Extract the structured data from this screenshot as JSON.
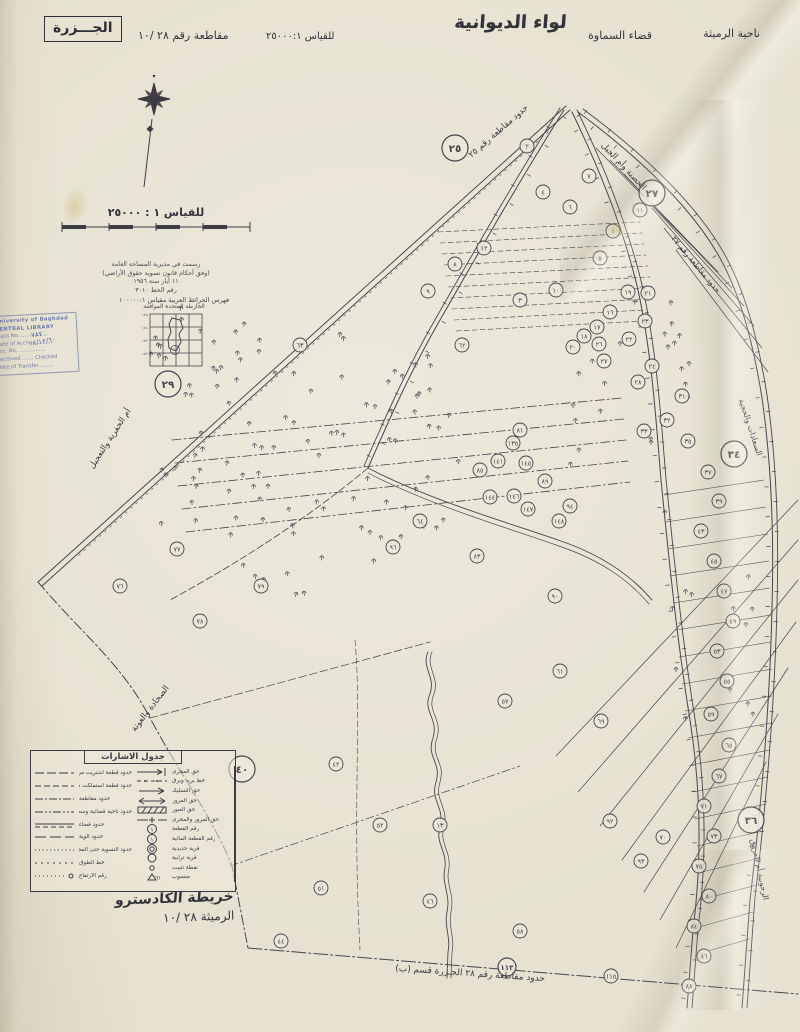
{
  "header": {
    "nahiya": "ناحية الرميثة",
    "qadha": "قضاء السماوة",
    "liwa": "لواء الديوانية",
    "scale_note": "للقياس ٢٥٠٠٠:١",
    "district_no": "مقاطعة رقم ٢٨ /١٠",
    "name_boxed": "الجـــزرة"
  },
  "scale_block": {
    "scale_text": "للقياس ١ : ٢٥٠٠٠",
    "notes": [
      "رسمت في مديرية المساحة العامة",
      "(وفق أحكام قانون تسوية حقوق الأراضي)",
      "١١ أيار سنة ١٩٥٦",
      "رقم الخط ٣٠١٠"
    ]
  },
  "index_map": {
    "title": "فهرس الخرائط العربية مقياس ١٠٠٠٠٠:١",
    "subtitle": "الخارطة المتحدة الموافقة"
  },
  "stamp": {
    "org": "University of Baghdad",
    "library": "CENTRAL LIBRARY",
    "fields": [
      "Class No. ................",
      "Date of Accng. ..........",
      "Acc. No. ................",
      "Received ....... Checked",
      "Date of Transfer ........"
    ],
    "handwritten1": "٧٨٧",
    "handwritten2": "٨/١٢/٦٠"
  },
  "legend": {
    "title": "جدول الاشارات",
    "right_items": [
      {
        "label": "حق المجرى",
        "sym": "flow"
      },
      {
        "label": "خط بريد وبرق",
        "sym": "telegraph"
      },
      {
        "label": "حق التسليك",
        "sym": "arrow"
      },
      {
        "label": "حق المرور",
        "sym": "dblarrow"
      },
      {
        "label": "حق العبور",
        "sym": "band"
      },
      {
        "label": "حق المرور والمجرى",
        "sym": "dashplus"
      },
      {
        "label": "رقم القطعة",
        "sym": "circle1"
      },
      {
        "label": "رقم القطعة المائية",
        "sym": "circle1"
      },
      {
        "label": "قرية حديدية",
        "sym": "dblcircle"
      },
      {
        "label": "قرية ترابية",
        "sym": "circle"
      },
      {
        "label": "نقطة تثبيت",
        "sym": "smallcircle"
      },
      {
        "label": "منسوب",
        "sym": "bench"
      }
    ],
    "left_items": [
      {
        "label": "حدود قطعة اشتريت من قبل مديرية الري",
        "style": "longdash"
      },
      {
        "label": "حدود قطعة استملكت من قبل الحكومة",
        "style": "dash2"
      },
      {
        "label": "حدود مقاطعة",
        "style": "dashdot"
      },
      {
        "label": "حدود ناحية قضائية وسط نهر",
        "style": "dashdotdot"
      },
      {
        "label": "حدود قضاء",
        "style": "soliddash"
      },
      {
        "label": "حدود ألوية",
        "style": "longdash2"
      },
      {
        "label": "حدود التسوية حتى المجرى",
        "style": "dotted"
      },
      {
        "label": "خط الطوق",
        "style": "dotsquares"
      },
      {
        "label": "رقم الارتفاع",
        "style": "dotso"
      }
    ]
  },
  "footer": {
    "map_type": "خريطة الكادسترو",
    "sheet": "الرميثة ٢٨ /١٠"
  },
  "map": {
    "ink_color": "#45454e",
    "paper_color": "#e6e1d0",
    "boundary_labels": [
      {
        "text": "حدود مقاطعة رقم ٢٥",
        "x": 500,
        "y": 133,
        "rot": -41,
        "size": 8.5
      },
      {
        "text": "الحصنة وأم الجبل",
        "x": 622,
        "y": 168,
        "rot": 47,
        "size": 8.5
      },
      {
        "text": "حدود مقاطعة رقم ٢٧",
        "x": 694,
        "y": 266,
        "rot": 50,
        "size": 8
      },
      {
        "text": "أم الحفرية والتعجيل",
        "x": 112,
        "y": 440,
        "rot": -57,
        "size": 8.5
      },
      {
        "text": "الصحادة والعوتة",
        "x": 152,
        "y": 710,
        "rot": -52,
        "size": 8.5
      },
      {
        "text": "السعادات والحجية",
        "x": 748,
        "y": 428,
        "rot": 72,
        "size": 8
      },
      {
        "text": "الرحوبية أم العروق",
        "x": 757,
        "y": 870,
        "rot": 78,
        "size": 8
      },
      {
        "text": "حدود مقاطعة رقم ٢٨  الجـزرة قسم (ب)",
        "x": 470,
        "y": 976,
        "rot": 4,
        "size": 9
      }
    ],
    "big_circles": [
      [
        "٢٥",
        455,
        148,
        13
      ],
      [
        "٢٧",
        652,
        193,
        13
      ],
      [
        "٢٩",
        168,
        384,
        13
      ],
      [
        "٣٤",
        734,
        454,
        13
      ],
      [
        "٤٠",
        242,
        769,
        13
      ],
      [
        "٣٦",
        751,
        820,
        13
      ],
      [
        "١١٣",
        507,
        967,
        9
      ]
    ],
    "parcels": [
      [
        "٢",
        527,
        146
      ],
      [
        "٤",
        543,
        192
      ],
      [
        "٧",
        589,
        176
      ],
      [
        "٦",
        570,
        207
      ],
      [
        "١",
        613,
        231
      ],
      [
        "٥",
        600,
        258
      ],
      [
        "١٢",
        484,
        248
      ],
      [
        "٨",
        455,
        264
      ],
      [
        "٩",
        428,
        291
      ],
      [
        "٣",
        520,
        300
      ],
      [
        "١٠",
        556,
        290
      ],
      [
        "١١",
        640,
        210
      ],
      [
        "١٦",
        610,
        312
      ],
      [
        "١٧",
        597,
        327
      ],
      [
        "١٨",
        584,
        336
      ],
      [
        "٢٠",
        573,
        347
      ],
      [
        "٢٦",
        599,
        344
      ],
      [
        "٢٢",
        629,
        339
      ],
      [
        "١٩",
        628,
        292
      ],
      [
        "٢١",
        648,
        293
      ],
      [
        "٢٣",
        645,
        321
      ],
      [
        "٢٤",
        652,
        366
      ],
      [
        "٢٨",
        638,
        382
      ],
      [
        "٢٧",
        604,
        361
      ],
      [
        "٣١",
        682,
        396
      ],
      [
        "٣٢",
        667,
        420
      ],
      [
        "٣٣",
        644,
        431
      ],
      [
        "٣٥",
        688,
        441
      ],
      [
        "٣٧",
        708,
        472
      ],
      [
        "٣٩",
        719,
        501
      ],
      [
        "٤٣",
        701,
        531
      ],
      [
        "٤٥",
        714,
        561
      ],
      [
        "٤٧",
        724,
        591
      ],
      [
        "٤٩",
        733,
        621
      ],
      [
        "٥٣",
        717,
        651
      ],
      [
        "٥٥",
        727,
        681
      ],
      [
        "٥٩",
        711,
        714
      ],
      [
        "٦٥",
        729,
        745
      ],
      [
        "٦٧",
        719,
        776
      ],
      [
        "٧١",
        704,
        806
      ],
      [
        "٧٣",
        714,
        836
      ],
      [
        "٧٥",
        699,
        866
      ],
      [
        "٨٠",
        709,
        896
      ],
      [
        "٨٤",
        694,
        926
      ],
      [
        "٨٦",
        704,
        956
      ],
      [
        "٨٨",
        689,
        986
      ],
      [
        "٦٢",
        462,
        345
      ],
      [
        "٦٣",
        300,
        345
      ],
      [
        "٨١",
        520,
        430
      ],
      [
        "٨٥",
        480,
        470
      ],
      [
        "٨٩",
        545,
        481
      ],
      [
        "٩٤",
        570,
        506
      ],
      [
        "١٣٥",
        513,
        443
      ],
      [
        "١٤١",
        498,
        461
      ],
      [
        "١٤٥",
        526,
        463
      ],
      [
        "١٤٤",
        490,
        497
      ],
      [
        "١٤٦",
        514,
        496
      ],
      [
        "١٤٧",
        528,
        509
      ],
      [
        "١٤٨",
        559,
        521
      ],
      [
        "٦٤",
        420,
        521
      ],
      [
        "٨٣",
        477,
        556
      ],
      [
        "٩٠",
        555,
        596
      ],
      [
        "٩٦",
        393,
        547
      ],
      [
        "٧٧",
        177,
        549
      ],
      [
        "٧٦",
        120,
        586
      ],
      [
        "٧٨",
        200,
        621
      ],
      [
        "٧٩",
        261,
        586
      ],
      [
        "٥٧",
        505,
        701
      ],
      [
        "٦١",
        560,
        671
      ],
      [
        "٦٩",
        601,
        721
      ],
      [
        "٤٢",
        336,
        764
      ],
      [
        "٥٢",
        380,
        825
      ],
      [
        "١٣",
        440,
        825
      ],
      [
        "٥١",
        321,
        888
      ],
      [
        "٤٦",
        430,
        901
      ],
      [
        "٥٨",
        520,
        931
      ],
      [
        "٩٢",
        610,
        821
      ],
      [
        "٩٣",
        641,
        861
      ],
      [
        "٤٤",
        281,
        941
      ],
      [
        "٧٠",
        663,
        837
      ],
      [
        "١١٥",
        611,
        976
      ]
    ]
  }
}
